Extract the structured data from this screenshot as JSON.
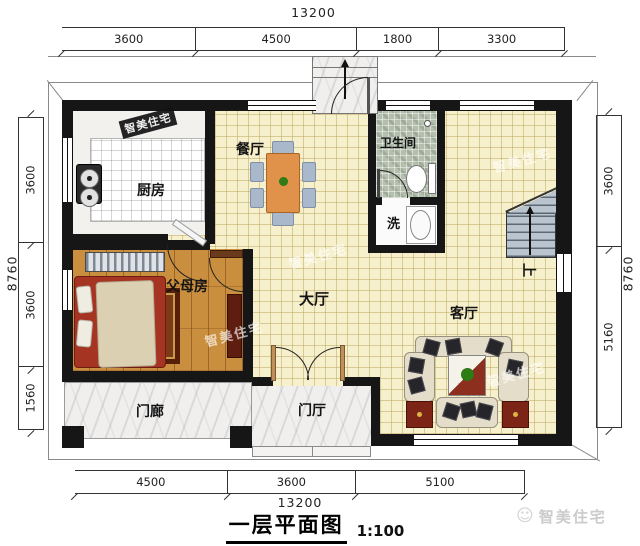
{
  "plan": {
    "rooms": {
      "kitchen": "厨房",
      "dining": "餐厅",
      "bathroom": "卫生间",
      "wash": "洗",
      "hall": "大厅",
      "living": "客厅",
      "parents_room": "父母房",
      "porch": "门廊",
      "foyer": "门厅",
      "stairs_up": "上"
    },
    "dimensions": {
      "top": {
        "total": "13200",
        "segments": [
          "3600",
          "4500",
          "1800",
          "3300"
        ]
      },
      "bottom": {
        "total": "13200",
        "segments": [
          "4500",
          "3600",
          "5100"
        ]
      },
      "left": {
        "total": "8760",
        "segments": [
          "3600",
          "3600",
          "1560"
        ]
      },
      "right": {
        "total": "8760",
        "segments": [
          "3600",
          "5160"
        ]
      }
    },
    "colors": {
      "wall": "#161616",
      "floor_tile": "#f7f0cc",
      "floor_wood": "#c98f3e",
      "floor_bath": "#b4bfae",
      "floor_marble": "#f0efee",
      "dining_table": "#e0914a",
      "chair": "#a9b8cb",
      "stairs": "#bac4ce",
      "bed": "#a63422",
      "cabinet": "#5f1d10"
    }
  },
  "title": {
    "text": "一层平面图",
    "scale": "1:100"
  },
  "brand": {
    "name": "智美住宅",
    "logo_glyph": "☺"
  }
}
